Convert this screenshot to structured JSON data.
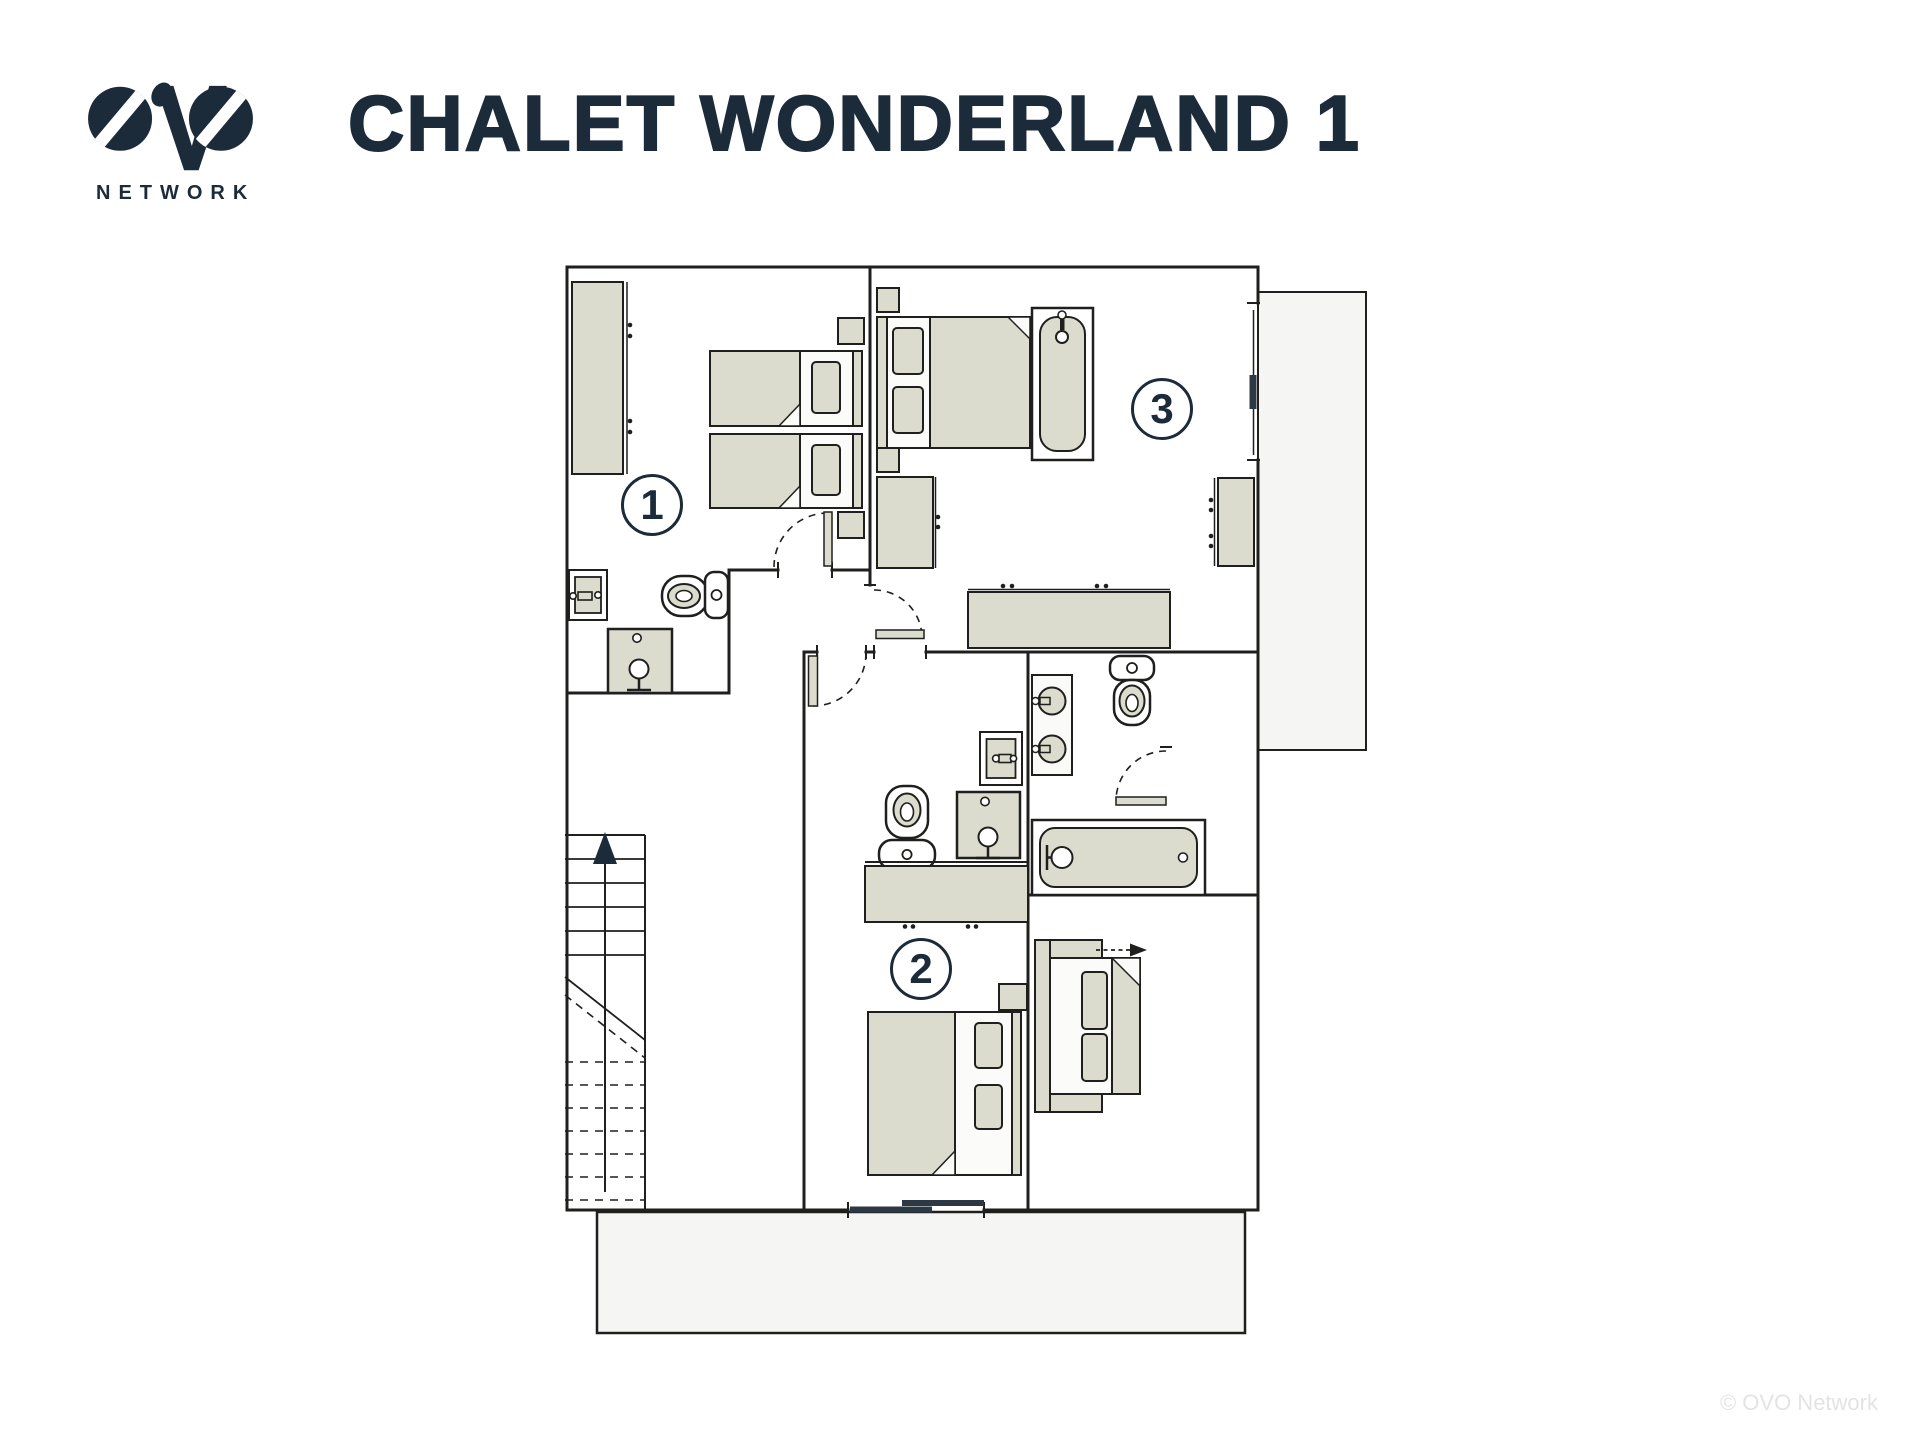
{
  "header": {
    "logo": {
      "brand": "OVO",
      "subtext": "NETWORK"
    },
    "title": "CHALET WONDERLAND 1"
  },
  "floorplan": {
    "rooms": [
      {
        "number": "1",
        "type": "twin bedroom with open en-suite"
      },
      {
        "number": "2",
        "type": "double bedroom with open en-suite"
      },
      {
        "number": "3",
        "type": "double bedroom with bathtub"
      }
    ]
  },
  "footer": {
    "copyright": "© OVO Network"
  },
  "colors": {
    "ink": "#1f1f1d",
    "navy": "#1c2b3a",
    "furniture": "#dcdcce",
    "linen": "#fbfbfa",
    "outdoor": "#f5f5f3",
    "door_leaf_dark": "#2c3844",
    "footer_text": "#e3e3e3"
  }
}
